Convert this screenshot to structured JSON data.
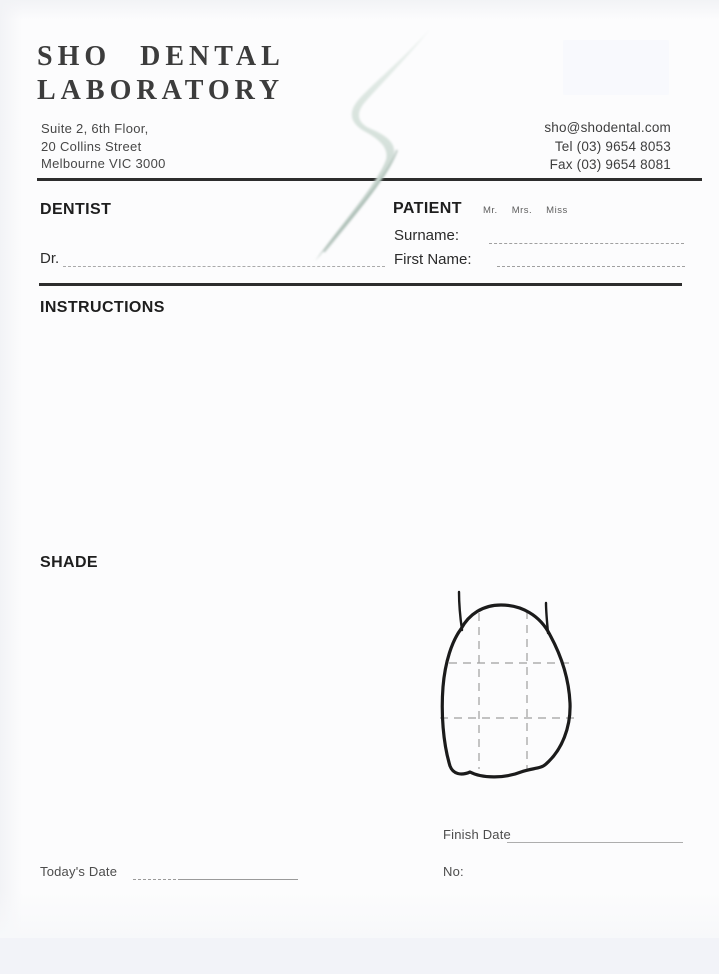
{
  "page": {
    "width": 719,
    "height": 974,
    "kind": "dental laboratory order form (scanned)"
  },
  "header": {
    "brand_line1": "SHO DENTAL",
    "brand_line2": "LABORATORY",
    "address_lines": [
      "Suite 2, 6th Floor,",
      "20 Collins Street",
      "Melbourne VIC 3000"
    ],
    "email": "sho@shodental.com",
    "tel": "Tel (03) 9654 8053",
    "fax": "Fax (03) 9654 8081"
  },
  "dentist": {
    "label": "DENTIST",
    "dr_label": "Dr."
  },
  "patient": {
    "label": "PATIENT",
    "titles": [
      "Mr.",
      "Mrs.",
      "Miss"
    ],
    "surname_label": "Surname:",
    "first_name_label": "First Name:"
  },
  "sections": {
    "instructions_label": "INSTRUCTIONS",
    "shade_label": "SHADE"
  },
  "footer": {
    "finish_date_label": "Finish Date",
    "no_label": "No:",
    "todays_date_label": "Today's Date"
  },
  "colors": {
    "ink": "#1e1e1e",
    "rule": "#2d2d2d",
    "fill_line": "#9c9c9c",
    "swoosh_accent": "#b6c7bf",
    "paper": "#fcfcfd"
  }
}
